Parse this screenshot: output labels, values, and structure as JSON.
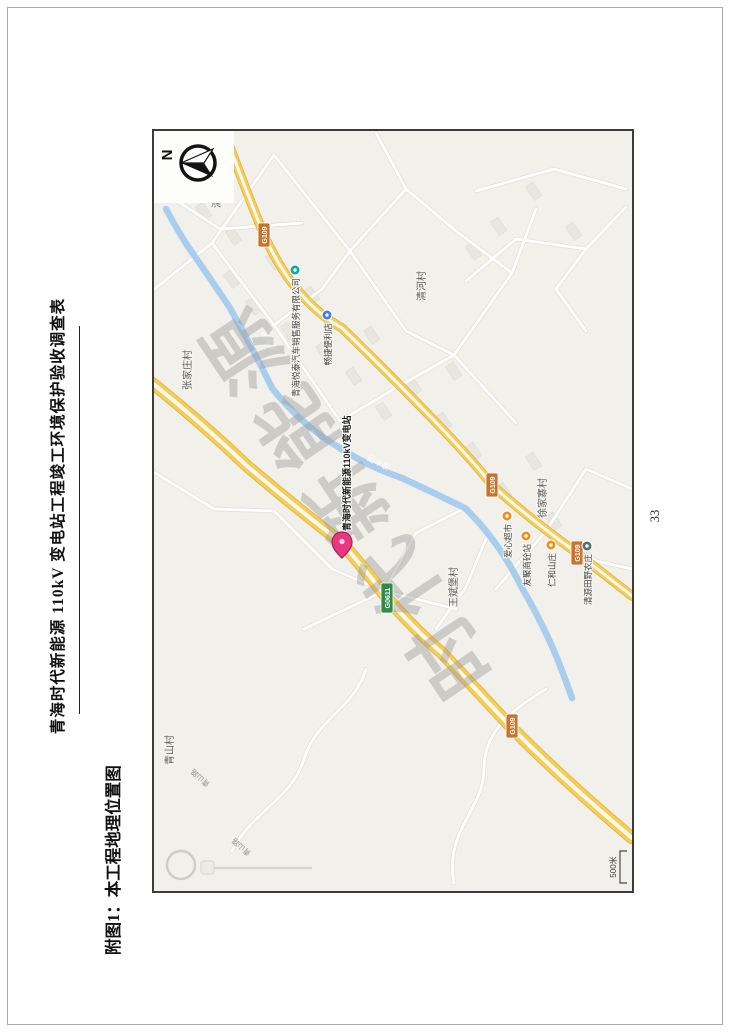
{
  "page": {
    "header_title": "青海时代新能源 110kV 变电站工程竣工环境保护验收调查表",
    "figure_caption": "附图1：本工程地理位置图",
    "page_number": "33"
  },
  "map": {
    "compass_label": "N",
    "watermark_text": "时代新能源",
    "scale_label": "500米",
    "site_marker": {
      "label": "青海时代新能源110kV变电站",
      "color": "#e83980",
      "stroke": "#a81b5b"
    },
    "villages": [
      {
        "name": "清水河村"
      },
      {
        "name": "张家庄村"
      },
      {
        "name": "清河村"
      },
      {
        "name": "王斌堡村"
      },
      {
        "name": "徐家寨村"
      },
      {
        "name": "青山村"
      }
    ],
    "pois": [
      {
        "name": "青海悦泰汽车销售服务有限公司",
        "color": "#12a5a9"
      },
      {
        "name": "畅捷便利店",
        "color": "#3f7de8"
      },
      {
        "name": "爱心超市",
        "color": "#f08f1f"
      },
      {
        "name": "友聚商砼站",
        "color": "#f08f1f"
      },
      {
        "name": "仁和山庄",
        "color": "#f08f1f"
      },
      {
        "name": "清源田野农庄",
        "color": "#52707d"
      }
    ],
    "road_shields": [
      {
        "code": "G109",
        "color": "#c9742e"
      },
      {
        "code": "G109",
        "color": "#c9742e"
      },
      {
        "code": "G109",
        "color": "#c9742e"
      },
      {
        "code": "G109",
        "color": "#c9742e"
      },
      {
        "code": "G0611",
        "color": "#2f8c46"
      }
    ],
    "river_labels": [
      {
        "name": "湟水河"
      },
      {
        "name": "湟水河"
      }
    ],
    "road_labels": [
      {
        "name": "青山路"
      },
      {
        "name": "青山路"
      }
    ]
  },
  "colors": {
    "road_fill": "#f3cd55",
    "road_casing": "#dfb13e",
    "road_center": "#fbf8f0",
    "river": "#a9cdec",
    "map_background": "#f2f0eb"
  }
}
